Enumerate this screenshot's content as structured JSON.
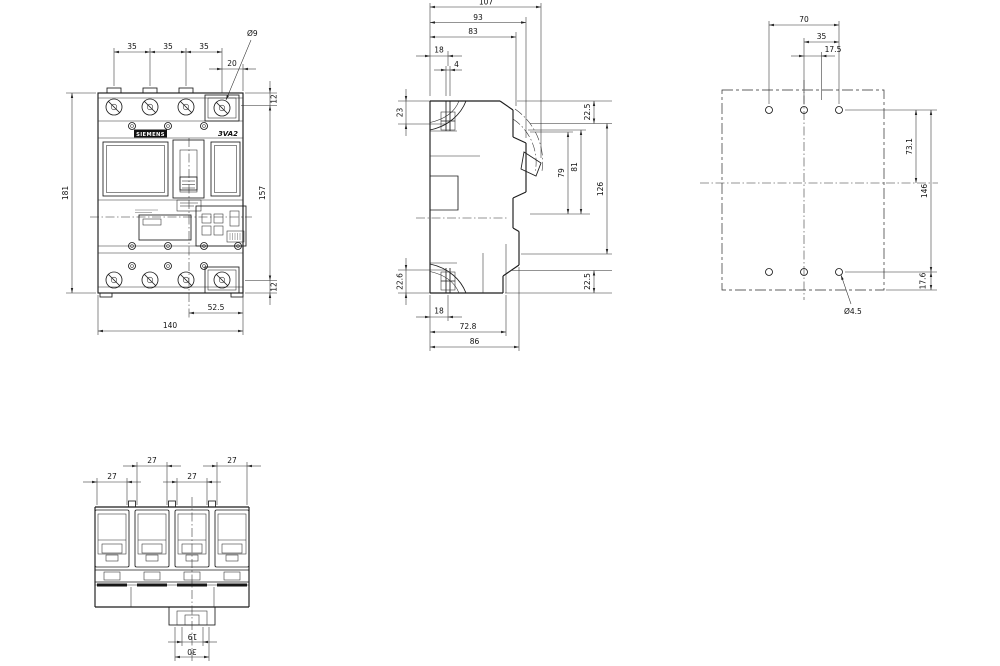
{
  "labels": {
    "brand": "SIEMENS",
    "model": "3VA2"
  },
  "views": {
    "front": {
      "dims": {
        "pole_pitch": [
          "35",
          "35",
          "35"
        ],
        "neutral_margin": "20",
        "terminal_hole_dia": "Ø9",
        "top_offset": "12",
        "terminal_span": "157",
        "bottom_offset": "12",
        "overall_height": "181",
        "center_to_edge": "52.5",
        "overall_width": "140"
      }
    },
    "side": {
      "dims": {
        "overall_depth": "107",
        "escutcheon_depth": "93",
        "front_depth": "83",
        "screw_offset_top": "18",
        "screw_slot_width": "4",
        "rear_top_offset": "23",
        "rear_bottom_offset": "22.6",
        "front_top_offset": "22.5",
        "front_bottom_offset": "22.5",
        "window_height": "79",
        "cover_height": "81",
        "front_span": "126",
        "screw_offset_bottom": "18",
        "base_depth": "72.8",
        "body_depth": "86"
      }
    },
    "drilling": {
      "dims": {
        "outer_hole_span": "70",
        "hole_pitch": "35",
        "half_pitch": "17.5",
        "row_to_center": "73.1",
        "row_span": "146",
        "bottom_edge_offset": "17.6",
        "mounting_hole_dia": "Ø4.5"
      }
    },
    "bottom": {
      "dims": {
        "terminal_widths": [
          "27",
          "27",
          "27",
          "27"
        ],
        "foot_slot_width": "19",
        "foot_width": "30"
      }
    }
  }
}
